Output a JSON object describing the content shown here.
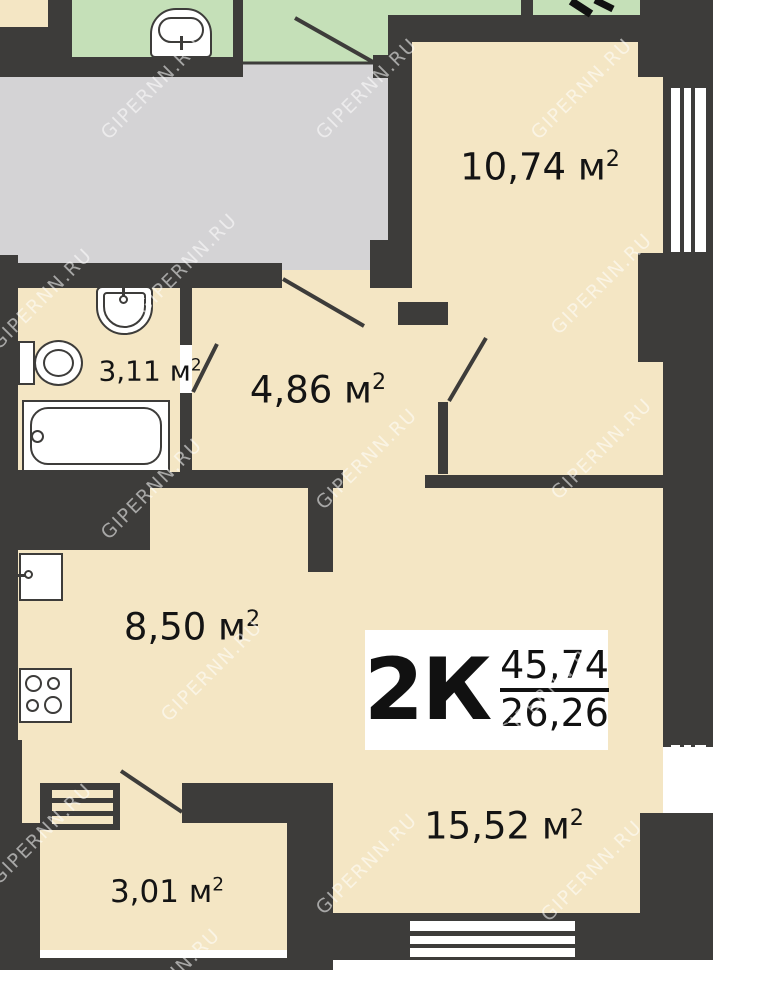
{
  "plan": {
    "watermark_text": "GIPERNN.RU",
    "apartment": {
      "rooms_type": "2К",
      "area_total": "45,74",
      "area_living": "26,26"
    },
    "room_labels": {
      "bedroom": {
        "text": "10,74 м",
        "sup": "2"
      },
      "hallway": {
        "text": "4,86 м",
        "sup": "2"
      },
      "bathroom": {
        "text": "3,11 м",
        "sup": "2"
      },
      "kitchen": {
        "text": "8,50 м",
        "sup": "2"
      },
      "living": {
        "text": "15,52 м",
        "sup": "2"
      },
      "loggia": {
        "text": "3,01 м",
        "sup": "2"
      }
    },
    "colors": {
      "wall": "#3d3c3a",
      "room_fill": "#f4e6c4",
      "corridor_fill": "#d4d3d5",
      "neighbor_fill": "#c5e0b8",
      "fixture_fill": "#ffffff",
      "label_text": "#141414"
    }
  }
}
